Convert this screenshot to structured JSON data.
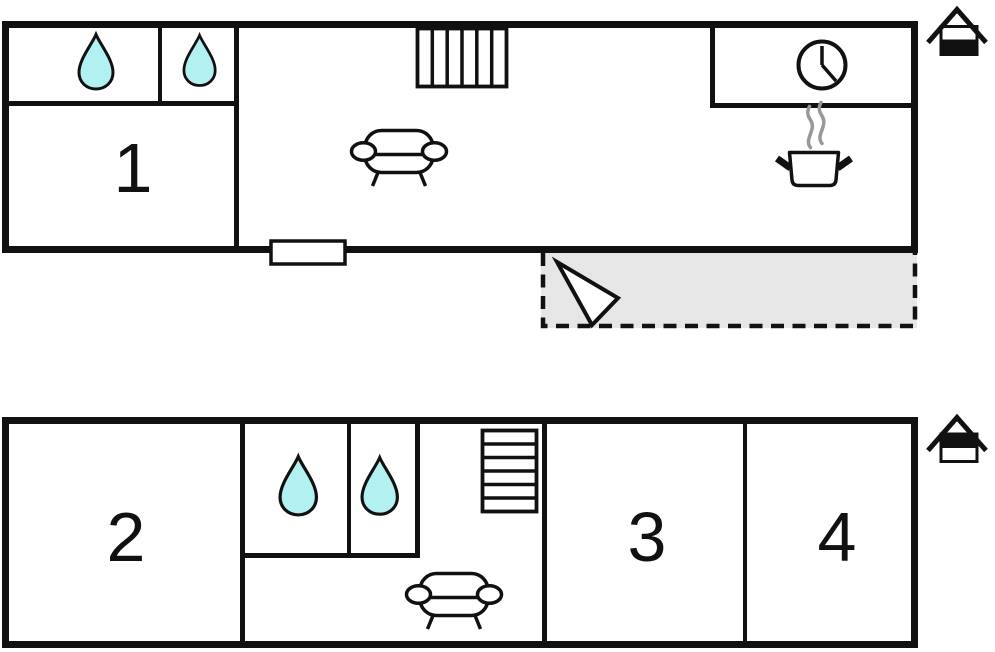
{
  "ground_floor": {
    "room_labels": {
      "room1": "1"
    },
    "icons": {
      "bath_drops": [
        "water-drop-icon",
        "water-drop-icon"
      ],
      "stairs": "stairs-icon",
      "sofa": "sofa-icon",
      "clock": "wall-clock-icon",
      "cooking_pot": "cooking-pot-icon",
      "steam": "steam-icon",
      "window": "window-symbol",
      "terrace_arrow": "entrance-arrow-icon",
      "level_indicator": "house-ground-level-icon"
    }
  },
  "upper_floor": {
    "room_labels": {
      "room2": "2",
      "room3": "3",
      "room4": "4"
    },
    "icons": {
      "bath_drops": [
        "water-drop-icon",
        "water-drop-icon"
      ],
      "stairs": "stairs-icon",
      "sofa": "sofa-icon",
      "level_indicator": "house-upper-level-icon"
    }
  },
  "colors": {
    "wall": "#111111",
    "water_drop_fill": "#b2f0f2",
    "terrace_fill": "#e6e6e6",
    "steam": "#999999",
    "background": "#ffffff"
  }
}
